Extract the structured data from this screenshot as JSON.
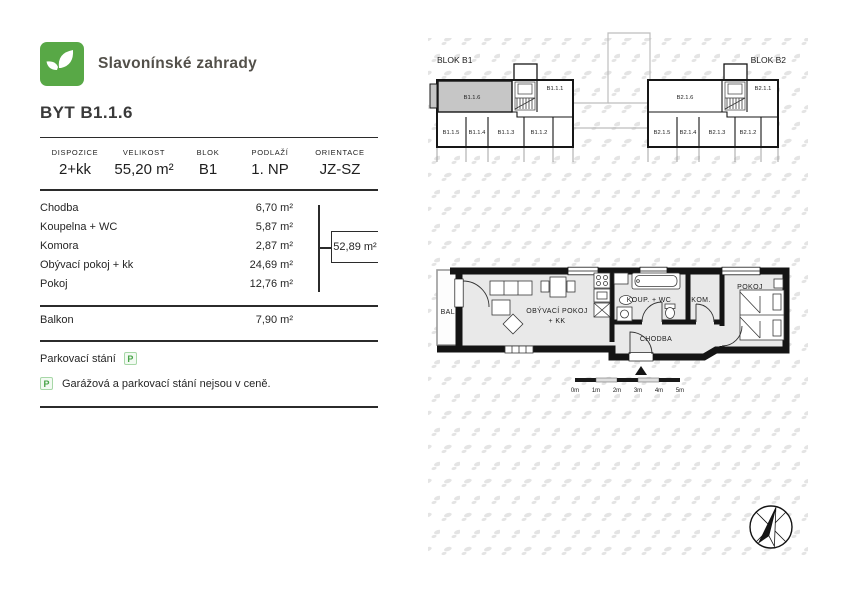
{
  "brand": {
    "name": "Slavonínské zahrady"
  },
  "title": "BYT B1.1.6",
  "summary": [
    {
      "label": "DISPOZICE",
      "value": "2+kk"
    },
    {
      "label": "VELIKOST",
      "value": "55,20 m²"
    },
    {
      "label": "BLOK",
      "value": "B1"
    },
    {
      "label": "PODLAŽÍ",
      "value": "1. NP"
    },
    {
      "label": "ORIENTACE",
      "value": "JZ-SZ"
    }
  ],
  "rooms": [
    {
      "name": "Chodba",
      "area": "6,70 m²"
    },
    {
      "name": "Koupelna + WC",
      "area": "5,87 m²"
    },
    {
      "name": "Komora",
      "area": "2,87 m²"
    },
    {
      "name": "Obývací pokoj + kk",
      "area": "24,69 m²"
    },
    {
      "name": "Pokoj",
      "area": "12,76 m²"
    }
  ],
  "total_area": "52,89 m²",
  "balcony": {
    "name": "Balkon",
    "area": "7,90 m²"
  },
  "parking": {
    "label": "Parkovací stání",
    "icon_letter": "P",
    "note": "Garážová a parkovací stání nejsou v ceně."
  },
  "blocks": {
    "b1": {
      "label": "BLOK B1",
      "unit_top_left": "B1.1.6",
      "unit_top_right": "B1.1.1",
      "bottom": [
        "B1.1.5",
        "B1.1.4",
        "B1.1.3",
        "B1.1.2"
      ],
      "highlighted_unit": "B1.1.6"
    },
    "b2": {
      "label": "BLOK B2",
      "unit_top_left": "B2.1.6",
      "unit_top_right": "B2.1.1",
      "bottom": [
        "B2.1.5",
        "B2.1.4",
        "B2.1.3",
        "B2.1.2"
      ]
    }
  },
  "floorplan": {
    "labels": {
      "balcony": "BALKON",
      "living_1": "OBÝVACÍ POKOJ",
      "living_2": "+ KK",
      "bathroom": "KOUP. + WC",
      "hallway": "CHODBA",
      "storage": "KOM.",
      "bedroom": "POKOJ"
    },
    "scale": [
      "0m",
      "1m",
      "2m",
      "3m",
      "4m",
      "5m"
    ]
  },
  "colors": {
    "brand_green": "#58a846",
    "highlight_gray": "#c6c6c6",
    "plan_fill": "#e9e9e9",
    "wall_black": "#141414"
  }
}
